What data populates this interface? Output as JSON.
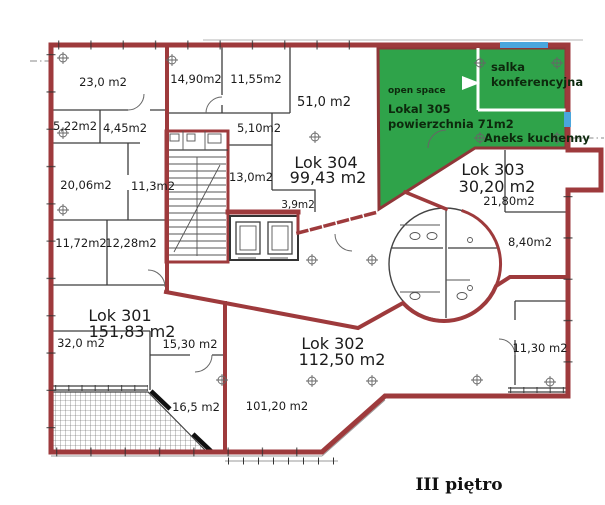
{
  "title": "III piętro",
  "units": {
    "lok301": {
      "name": "Lok 301",
      "area": "151,83 m2"
    },
    "lok302": {
      "name": "Lok 302",
      "area": "112,50 m2"
    },
    "lok303": {
      "name": "Lok 303",
      "area": "30,20 m2"
    },
    "lok304": {
      "name": "Lok 304",
      "area": "99,43 m2"
    }
  },
  "green_zone": {
    "open_space": "open space",
    "name": "Lokal 305",
    "area": "powierzchnia 71m2",
    "conference_line1": "salka",
    "conference_line2": "konferencyjna",
    "kitchenette": "Aneks kuchenny",
    "fill_color": "#2fa34a"
  },
  "rooms": {
    "r23": "23,0 m2",
    "r1490": "14,90m2",
    "r1155": "11,55m2",
    "r522": "5,22m2",
    "r445": "4,45m2",
    "r510": "5,10m2",
    "r51": "51,0 m2",
    "r2006": "20,06m2",
    "r113": "11,3m2",
    "r130": "13,0m2",
    "r39": "3,9m2",
    "r1172": "11,72m2",
    "r1228": "12,28m2",
    "r32": "32,0 m2",
    "r1530": "15,30 m2",
    "r165": "16,5 m2",
    "r10120": "101,20 m2",
    "r2180": "21,80m2",
    "r840": "8,40m2",
    "r1130": "11,30 m2"
  },
  "colors": {
    "wall_red": "#9e3a3c",
    "highlight_green": "#2fa34a",
    "window_blue": "#4aa6dd"
  }
}
